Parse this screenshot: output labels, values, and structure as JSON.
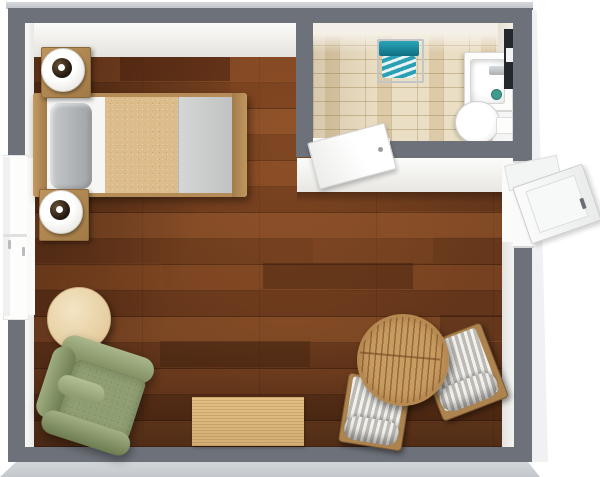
{
  "scene": {
    "title": "Studio apartment 3D floor plan, top-down view",
    "rooms": [
      {
        "name": "main room",
        "floor_material": "dark walnut wood planks",
        "furniture": [
          "single bed with tan and gray bedding",
          "nightstand with round lamp (top)",
          "nightstand with round lamp (bottom)",
          "round pale-wood side table",
          "green fabric armchair",
          "light wood area rug",
          "round slatted wood table",
          "striped cushion lounge chair (left)",
          "striped cushion lounge chair (right)"
        ]
      },
      {
        "name": "bathroom",
        "floor_material": "beige ceramic tiles",
        "fixtures": [
          "towel rack with teal towels",
          "sink vanity with faucet and green cup",
          "wall mirror",
          "toilet with tank",
          "open interior door"
        ]
      }
    ],
    "openings": [
      "window in left wall",
      "entry door in right wall, open outward",
      "bathroom door, open inward"
    ]
  },
  "colors": {
    "background": "#ffffff",
    "wall_gray": "#6d727a",
    "wall_outer_light": "#c9cdd1",
    "wall_inner_face": "#f6f6f4",
    "wood_floor": "#6e3c1e",
    "bathroom_tile": "#eadec4",
    "bed_frame_wood": "#b58c57",
    "bed_blanket_tan": "#dcbc8a",
    "bed_blanket_gray": "#c9cbca",
    "pillow_gray": "#aeb1b3",
    "armchair_green": "#8f9e72",
    "side_table_wood": "#ecd9b5",
    "slatted_table_wood": "#c79a5f",
    "chair_stripe_light": "#f3f1ec",
    "chair_stripe_dark": "#bcbbb6",
    "towel_teal": "#1e93a8",
    "rug_wood": "#dcb77e",
    "mirror_dark": "#24272b"
  }
}
